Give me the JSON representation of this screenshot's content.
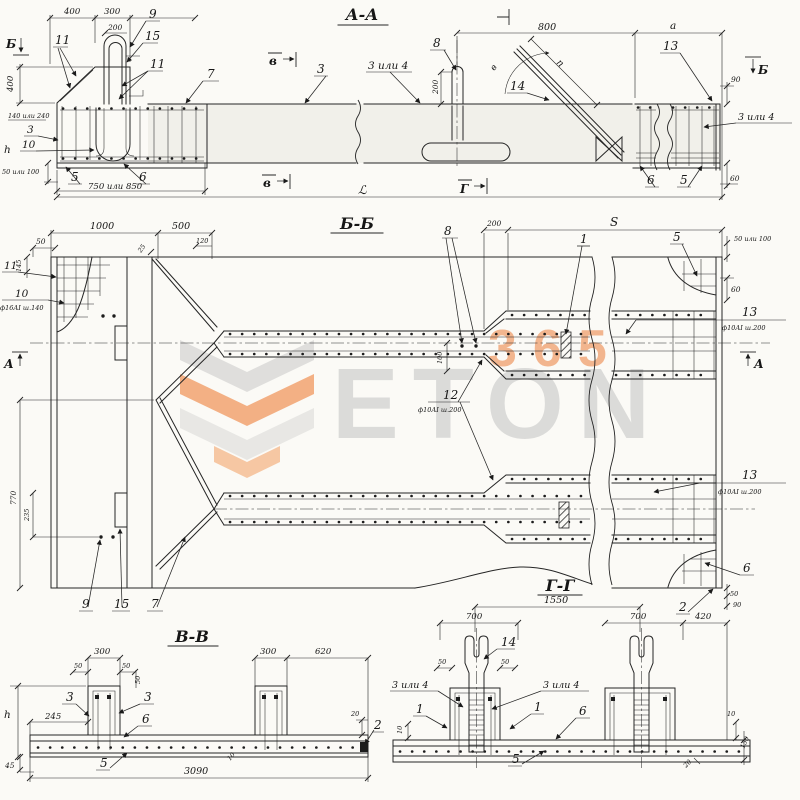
{
  "wm": {
    "brand": "ETON",
    "number": "365",
    "orange": "#f3a878",
    "gray": "#dcdcda"
  },
  "aa": {
    "title": "А-А",
    "d400": "400",
    "d300": "300",
    "d200": "200",
    "d400v": "400",
    "d140": "140 или 240",
    "l3": "3",
    "l10": "10",
    "lh": "h",
    "d50": "50 или 100",
    "l5": "5",
    "d750": "750 или 850",
    "l6": "6",
    "l9": "9",
    "l15": "15",
    "l11a": "11",
    "l11b": "11",
    "l7": "7",
    "mB": "Б",
    "mV1": "в",
    "mV2": "в",
    "mG": "Г",
    "mBr": "Б",
    "l3m": "3",
    "l3or4": "3 или 4",
    "l8": "8",
    "d200v": "200",
    "d800": "800",
    "da": "а",
    "ang": "в",
    "dn": "n",
    "l14": "14",
    "l13": "13",
    "d90": "90",
    "l3or4r": "3 или 4",
    "l6r": "6",
    "l5r": "5",
    "d60": "60",
    "dL": "ℒ"
  },
  "bb": {
    "title": "Б-Б",
    "d50": "50",
    "d1000": "1000",
    "d500": "500",
    "d120": "120",
    "d25": "25",
    "d145": "145",
    "l11": "11",
    "l10": "10",
    "n10": "ф16АI ш.140",
    "mAl": "А",
    "mAr": "А",
    "l8": "8",
    "d200": "200",
    "dS": "S",
    "l1": "1",
    "l5": "5",
    "d50100": "50 или 100",
    "d60": "60",
    "l13a": "13",
    "n13a": "ф10АI ш.200",
    "l12": "12",
    "n12": "ф10АI ш.200",
    "d100": "100",
    "l13b": "13",
    "n13b": "ф10АI ш.200",
    "d770": "770",
    "d235": "235",
    "l9": "9",
    "l15": "15",
    "l7": "7",
    "l6": "6",
    "l2": "2",
    "d50b": "50",
    "d90": "90"
  },
  "vv": {
    "title": "В-В",
    "d300a": "300",
    "d50a": "50",
    "d50b": "50",
    "d50c": "50",
    "d300b": "300",
    "d620": "620",
    "d245": "245",
    "dh": "h",
    "d45": "45",
    "l3a": "3",
    "l3b": "3",
    "l6": "6",
    "l5": "5",
    "l2": "2",
    "d20": "20",
    "d10": "10",
    "d3090": "3090"
  },
  "gg": {
    "title": "Г-Г",
    "d1550": "1550",
    "d700a": "700",
    "d700b": "700",
    "d420": "420",
    "d50a": "50",
    "d50b": "50",
    "l14": "14",
    "l3or4a": "3 или 4",
    "l3or4b": "3 или 4",
    "l1a": "1",
    "l1b": "1",
    "l6": "6",
    "l5": "5",
    "d10a": "10",
    "d10b": "10",
    "d150": "150",
    "d20": "20"
  }
}
